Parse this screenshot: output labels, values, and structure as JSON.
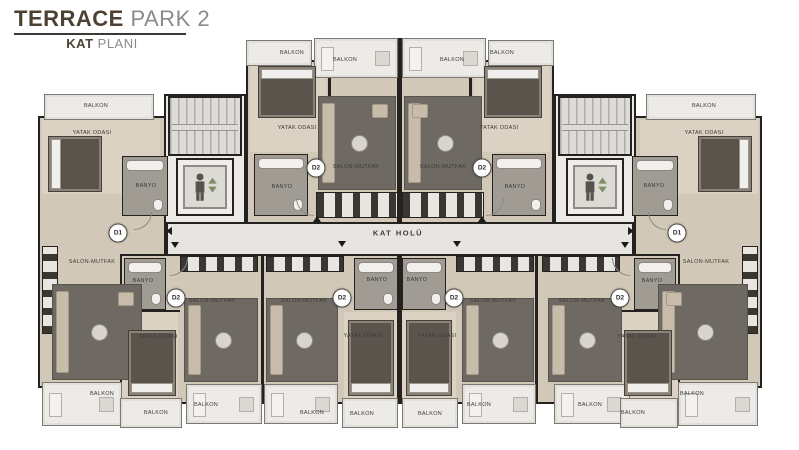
{
  "title": {
    "brand_primary": "TERRACE",
    "brand_secondary": "PARK 2",
    "subtitle_primary": "KAT",
    "subtitle_secondary": "PLANI"
  },
  "plan": {
    "corridor": {
      "label": "KAT HOLÜ",
      "x": 398,
      "y": 233
    },
    "unit_badges": [
      {
        "label": "D1",
        "x": 118,
        "y": 233
      },
      {
        "label": "D2",
        "x": 316,
        "y": 168
      },
      {
        "label": "D2",
        "x": 482,
        "y": 168
      },
      {
        "label": "D1",
        "x": 677,
        "y": 233
      },
      {
        "label": "D2",
        "x": 176,
        "y": 298
      },
      {
        "label": "D2",
        "x": 342,
        "y": 298
      },
      {
        "label": "D2",
        "x": 454,
        "y": 298
      },
      {
        "label": "D2",
        "x": 620,
        "y": 298
      }
    ],
    "room_labels": [
      {
        "text": "BALKON",
        "x": 96,
        "y": 106
      },
      {
        "text": "YATAK ODASI",
        "x": 92,
        "y": 133
      },
      {
        "text": "BANYO",
        "x": 146,
        "y": 186
      },
      {
        "text": "SALON-MUTFAK",
        "x": 92,
        "y": 262
      },
      {
        "text": "BALKON",
        "x": 102,
        "y": 394
      },
      {
        "text": "BALKON",
        "x": 292,
        "y": 53
      },
      {
        "text": "YATAK ODASI",
        "x": 297,
        "y": 128
      },
      {
        "text": "BANYO",
        "x": 282,
        "y": 187
      },
      {
        "text": "BALKON",
        "x": 345,
        "y": 60
      },
      {
        "text": "SALON-MUTFAK",
        "x": 356,
        "y": 167
      },
      {
        "text": "BALKON",
        "x": 452,
        "y": 60
      },
      {
        "text": "SALON-MUTFAK",
        "x": 443,
        "y": 167
      },
      {
        "text": "BALKON",
        "x": 502,
        "y": 53
      },
      {
        "text": "YATAK ODASI",
        "x": 499,
        "y": 128
      },
      {
        "text": "BANYO",
        "x": 515,
        "y": 187
      },
      {
        "text": "BALKON",
        "x": 704,
        "y": 106
      },
      {
        "text": "YATAK ODASI",
        "x": 704,
        "y": 133
      },
      {
        "text": "BANYO",
        "x": 654,
        "y": 186
      },
      {
        "text": "SALON-MUTFAK",
        "x": 706,
        "y": 262
      },
      {
        "text": "BALKON",
        "x": 692,
        "y": 394
      },
      {
        "text": "BANYO",
        "x": 143,
        "y": 281
      },
      {
        "text": "SALON-MUTFAK",
        "x": 212,
        "y": 301
      },
      {
        "text": "YATAK ODASI",
        "x": 158,
        "y": 337
      },
      {
        "text": "BALKON",
        "x": 156,
        "y": 413
      },
      {
        "text": "BALKON",
        "x": 206,
        "y": 405
      },
      {
        "text": "SALON-MUTFAK",
        "x": 304,
        "y": 301
      },
      {
        "text": "BANYO",
        "x": 377,
        "y": 280
      },
      {
        "text": "YATAK ODASI",
        "x": 363,
        "y": 336
      },
      {
        "text": "BALKON",
        "x": 312,
        "y": 413
      },
      {
        "text": "BALKON",
        "x": 362,
        "y": 414
      },
      {
        "text": "BANYO",
        "x": 417,
        "y": 280
      },
      {
        "text": "YATAK ODASI",
        "x": 437,
        "y": 336
      },
      {
        "text": "SALON-MUTFAK",
        "x": 493,
        "y": 301
      },
      {
        "text": "BALKON",
        "x": 430,
        "y": 414
      },
      {
        "text": "BALKON",
        "x": 479,
        "y": 405
      },
      {
        "text": "SALON-MUTFAK",
        "x": 582,
        "y": 301
      },
      {
        "text": "BANYO",
        "x": 652,
        "y": 281
      },
      {
        "text": "YATAK ODASI",
        "x": 637,
        "y": 337
      },
      {
        "text": "BALKON",
        "x": 590,
        "y": 405
      },
      {
        "text": "BALKON",
        "x": 633,
        "y": 413
      }
    ],
    "icons": {
      "elevator": "elevator-person-with-up-down-arrows-icon",
      "corridor_arrows": "unit-entrance-arrow-icons"
    }
  },
  "colors": {
    "title_brown": "#4c4132",
    "title_gray": "#8a8a8a",
    "wall": "#242220",
    "wood_floor": "#d2c8b7",
    "rug": "#6e6962",
    "bathroom": "#a09b93",
    "balcony": "#edebe7",
    "corridor": "#e7e5e1",
    "elevator_arrow_green": "#7e8e66"
  }
}
